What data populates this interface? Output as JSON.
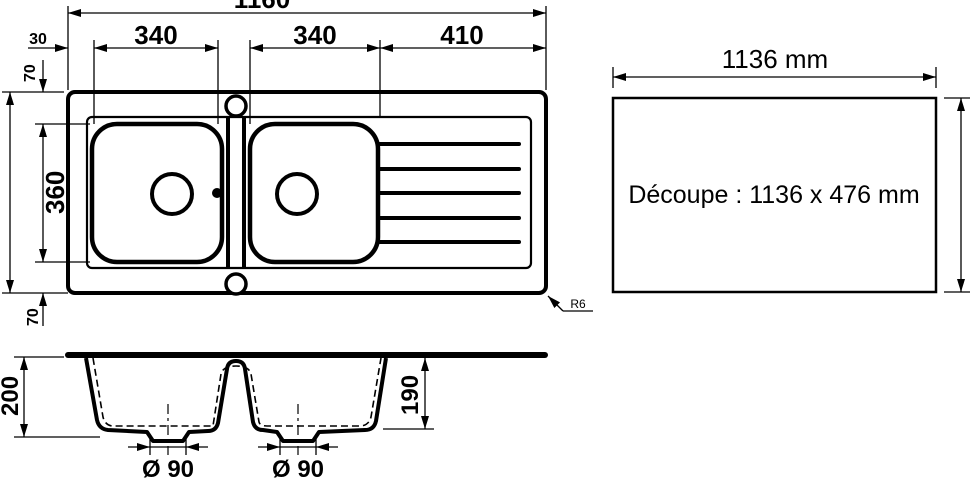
{
  "plan_view": {
    "dim_overall_width": "1160",
    "dim_left_rim": "30",
    "dim_bowl1_width": "340",
    "dim_bowl2_width": "340",
    "dim_drainer_width": "410",
    "dim_top_rim": "70",
    "dim_bowls_front_to_back": "360",
    "dim_bottom_rim": "70",
    "corner_radius_note": "R6"
  },
  "section_view": {
    "dim_overall_depth": "200",
    "dim_bowl_depth": "190",
    "dim_drain_left": "Ø 90",
    "dim_drain_right": "Ø 90"
  },
  "cutout_panel": {
    "dim_width": "1136 mm",
    "label": "Découpe : 1136 x 476 mm"
  },
  "colors": {
    "line": "#000000",
    "background": "#ffffff"
  }
}
